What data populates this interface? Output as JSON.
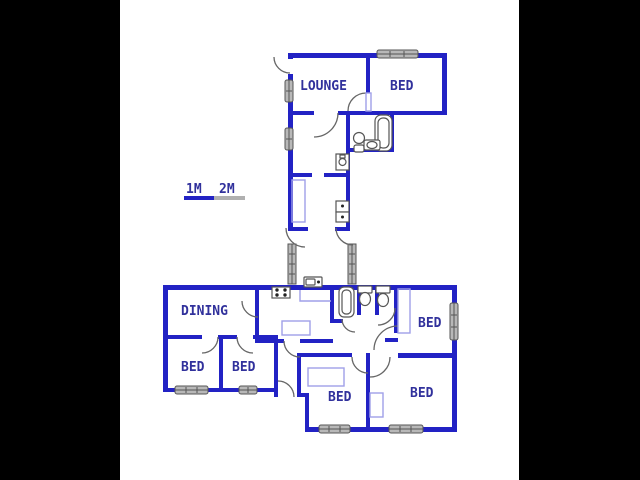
{
  "page": {
    "description": "Residential floor plan drawing, letterboxed on black",
    "background": "#000000",
    "plan_background": "#ffffff"
  },
  "colors": {
    "wall": "#2222c4",
    "light_fixture": "#9f9fe8",
    "window_fill": "#b8b8b8",
    "window_border": "#555555",
    "label_text": "#31319c",
    "scale_blue": "#2222c4",
    "scale_gray": "#b0b0b0"
  },
  "scale_bar": {
    "label_1m": "1M",
    "label_2m": "2M"
  },
  "rooms": {
    "lounge": "LOUNGE",
    "bed_top": "BED",
    "dining": "DINING",
    "bed_left": "BED",
    "bed_middle": "BED",
    "bed_right": "BED",
    "bed_bottom_middle": "BED",
    "bed_bottom_right": "BED"
  },
  "fixtures": {
    "upper_bathroom": [
      "bathtub",
      "toilet",
      "basin"
    ],
    "upper_corridor": [
      "geyser",
      "double-sink",
      "wardrobe"
    ],
    "kitchen": [
      "stove",
      "sink",
      "counter"
    ],
    "lower_sanitary": [
      "bathtub",
      "toilet",
      "toilet"
    ],
    "bedroom_builtins": [
      "cupboard",
      "cupboard",
      "cupboard"
    ]
  }
}
